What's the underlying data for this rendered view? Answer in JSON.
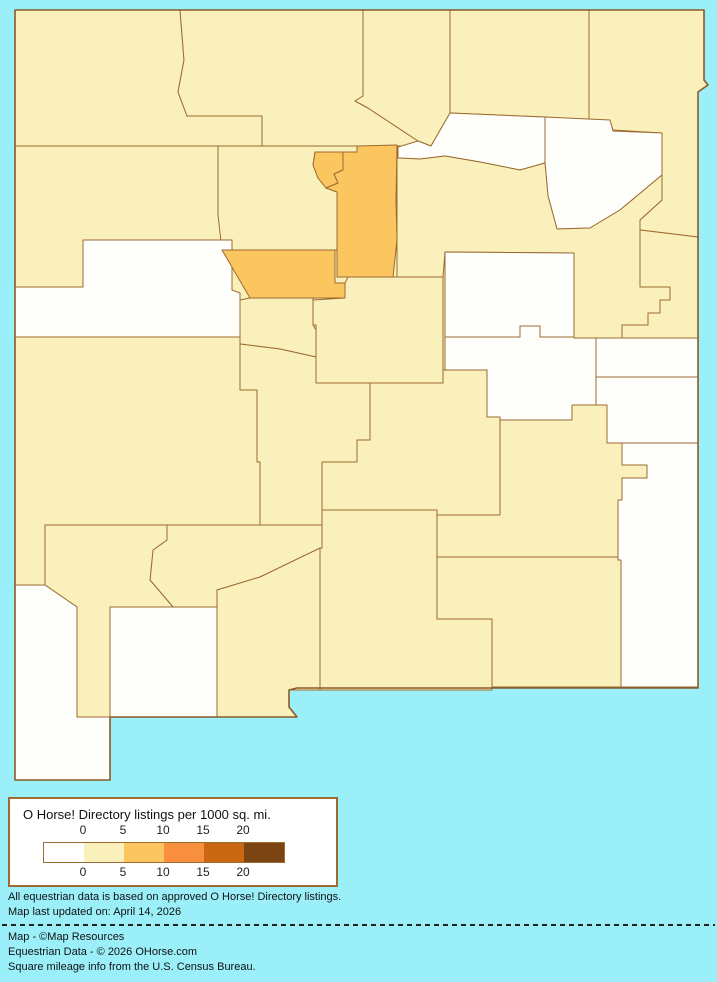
{
  "map": {
    "region_id": "new-mexico-county-choropleth",
    "border_color": "#9C6B31",
    "outline_color": "#8A5A28",
    "land_color": "#FAF0BC",
    "water_color": "#9BEFF8",
    "outline_path": "M15,10 L704,10 L704,80 L708,85 L698,92 L698,688 L297,688 L289,690 L289,707 L297,717 L110,717 L110,780 L15,780 Z",
    "palette": {
      "0": "#FEFEFA",
      "0-5": "#FAF0BC",
      "5-10": "#FBC55F",
      "10-15": "#F78F3E",
      "15-20": "#C96810",
      "20+": "#7B4513"
    },
    "counties": [
      {
        "id": "san-juan",
        "band": "0-5",
        "path": "M15,10 L180,10 L184,60 L178,92 L187,116 L262,116 L262,146 L15,146 Z"
      },
      {
        "id": "rio-arriba",
        "band": "0-5",
        "path": "M180,10 L363,10 L363,96 L355,101 L368,108 L418,141 L431,146 L397,146 L313,147 L262,146 L262,116 L187,116 L178,92 L184,60 Z"
      },
      {
        "id": "taos",
        "band": "0-5",
        "path": "M363,10 L450,10 L450,113 L431,146 L418,141 L368,108 L355,101 L363,96 Z"
      },
      {
        "id": "colfax",
        "band": "0-5",
        "path": "M450,10 L589,10 L589,122 L545,117 L450,113 Z"
      },
      {
        "id": "union",
        "band": "0-5",
        "path": "M589,10 L704,10 L704,80 L708,85 L698,92 L698,237 L640,230 L640,220 L662,200 L662,175 L662,133 L613,130 L610,121 L589,122 Z"
      },
      {
        "id": "harding",
        "band": "0",
        "path": "M545,117 L610,120 L613,131 L662,133 L662,175 L650,185 L620,210 L590,228 L557,229 L548,196 L545,163 Z"
      },
      {
        "id": "mora",
        "band": "0",
        "path": "M398,147 L418,141 L431,146 L450,113 L545,117 L545,163 L520,170 L480,162 L445,156 L420,159 L398,158 Z"
      },
      {
        "id": "san-miguel",
        "band": "0-5",
        "path": "M397,145 L398,158 L420,159 L445,156 L480,162 L520,170 L545,163 L548,196 L557,229 L590,228 L620,210 L650,185 L662,175 L662,200 L640,220 L640,287 L670,287 L670,300 L660,300 L660,313 L648,313 L648,325 L622,325 L622,338 L574,338 L574,253 L445,252 L443,277 L397,277 Z"
      },
      {
        "id": "quay",
        "band": "0-5",
        "path": "M640,230 L698,237 L698,338 L622,338 L622,325 L648,325 L648,313 L660,313 L660,300 L670,300 L670,287 L640,287 Z"
      },
      {
        "id": "mckinley",
        "band": "0-5",
        "path": "M15,146 L218,146 L218,215 L232,228 L232,240 L83,240 L83,287 L15,287 Z"
      },
      {
        "id": "sandoval",
        "band": "0-5",
        "path": "M218,146 L357,146 L357,152 L343,152 L315,152 L313,165 L318,178 L326,188 L337,192 L337,250 L222,250 L218,215 Z"
      },
      {
        "id": "los-alamos",
        "band": "5-10",
        "path": "M315,152 L343,152 L343,170 L334,174 L338,183 L326,188 L318,178 L313,165 Z"
      },
      {
        "id": "santa-fe",
        "band": "5-10",
        "path": "M357,146 L397,145 L396,200 L397,240 L393,277 L337,277 L337,192 L326,188 L338,183 L334,174 L343,170 L343,152 L357,152 Z"
      },
      {
        "id": "cibola",
        "band": "0",
        "path": "M15,287 L83,287 L83,240 L232,240 L232,290 L240,293 L240,337 L15,337 Z"
      },
      {
        "id": "bernalillo",
        "band": "5-10",
        "path": "M222,250 L335,250 L335,283 L345,283 L345,298 L250,298 Z"
      },
      {
        "id": "valencia",
        "band": "0-5",
        "path": "M240,300 L250,298 L313,298 L313,325 L316,330 L316,357 L280,349 L240,344 Z"
      },
      {
        "id": "torrance",
        "band": "0-5",
        "path": "M345,283 L348,277 L443,277 L443,383 L316,383 L316,325 L313,325 L313,300 L345,298 Z"
      },
      {
        "id": "guadalupe",
        "band": "0",
        "path": "M445,252 L574,253 L574,337 L540,337 L540,326 L520,326 L520,337 L445,337 Z"
      },
      {
        "id": "de-baca",
        "band": "0",
        "path": "M445,337 L520,337 L520,326 L540,326 L540,337 L574,337 L574,338 L596,338 L596,420 L500,420 L500,417 L487,417 L487,370 L445,370 Z"
      },
      {
        "id": "curry",
        "band": "0",
        "path": "M596,338 L698,338 L698,377 L596,377 Z"
      },
      {
        "id": "roosevelt",
        "band": "0",
        "path": "M596,377 L698,377 L698,443 L607,443 L607,420 L596,420 Z"
      },
      {
        "id": "catron",
        "band": "0-5",
        "path": "M15,337 L240,337 L240,390 L257,390 L257,462 L260,462 L260,525 L45,525 L45,585 L15,585 Z"
      },
      {
        "id": "socorro",
        "band": "0-5",
        "path": "M240,344 L280,349 L316,357 L316,383 L370,383 L370,440 L357,440 L357,462 L322,462 L322,525 L260,525 L260,462 L257,462 L257,390 L240,390 Z"
      },
      {
        "id": "lincoln",
        "band": "0-5",
        "path": "M370,383 L443,383 L443,370 L487,370 L487,417 L500,417 L500,515 L437,515 L437,510 L322,510 L322,462 L357,462 L357,440 L370,440 Z"
      },
      {
        "id": "chaves",
        "band": "0-5",
        "path": "M500,420 L572,420 L572,405 L607,405 L607,443 L622,443 L622,465 L647,465 L647,478 L622,478 L622,500 L618,500 L618,557 L437,557 L437,515 L500,515 Z"
      },
      {
        "id": "sierra",
        "band": "0-5",
        "path": "M167,525 L322,525 L322,548 L260,577 L217,590 L217,607 L173,607 L150,580 L153,550 L167,540 Z"
      },
      {
        "id": "grant",
        "band": "0-5",
        "path": "M45,525 L167,525 L167,540 L153,550 L150,580 L173,607 L110,607 L110,717 L77,717 L77,607 L45,585 Z"
      },
      {
        "id": "hidalgo",
        "band": "0",
        "path": "M15,585 L45,585 L77,607 L77,717 L110,717 L110,780 L15,780 Z"
      },
      {
        "id": "luna",
        "band": "0",
        "path": "M110,607 L217,607 L217,717 L110,717 Z"
      },
      {
        "id": "dona-ana",
        "band": "0-5",
        "path": "M217,590 L260,577 L320,548 L320,690 L289,690 L289,707 L297,717 L217,717 Z"
      },
      {
        "id": "otero",
        "band": "0-5",
        "path": "M322,510 L437,510 L437,619 L492,619 L492,690 L320,690 L320,548 L322,548 Z"
      },
      {
        "id": "eddy",
        "band": "0-5",
        "path": "M437,557 L618,557 L618,560 L621,560 L621,687 L492,687 L492,619 L437,619 Z"
      },
      {
        "id": "lea",
        "band": "0",
        "path": "M622,443 L698,443 L698,687 L621,687 L621,560 L618,560 L618,500 L622,500 L622,478 L647,478 L647,465 L622,465 Z"
      }
    ]
  },
  "legend": {
    "title": "O Horse! Directory listings per 1000 sq. mi.",
    "colors": [
      "#FFFFFF",
      "#FAF0BC",
      "#FBC55F",
      "#F78F3E",
      "#C96810",
      "#7B4513"
    ],
    "ticks_top": [
      "0",
      "5",
      "10",
      "15",
      "20"
    ],
    "ticks_bottom": [
      "0",
      "5",
      "10",
      "15",
      "20"
    ]
  },
  "notes": {
    "line1": "All equestrian data is based on approved O Horse! Directory listings.",
    "line2": "Map last updated on: April 14, 2026"
  },
  "credits": {
    "line1": "Map - ©Map Resources",
    "line2": "Equestrian Data - © 2026 OHorse.com",
    "line3": "Square mileage info from the U.S. Census Bureau."
  }
}
